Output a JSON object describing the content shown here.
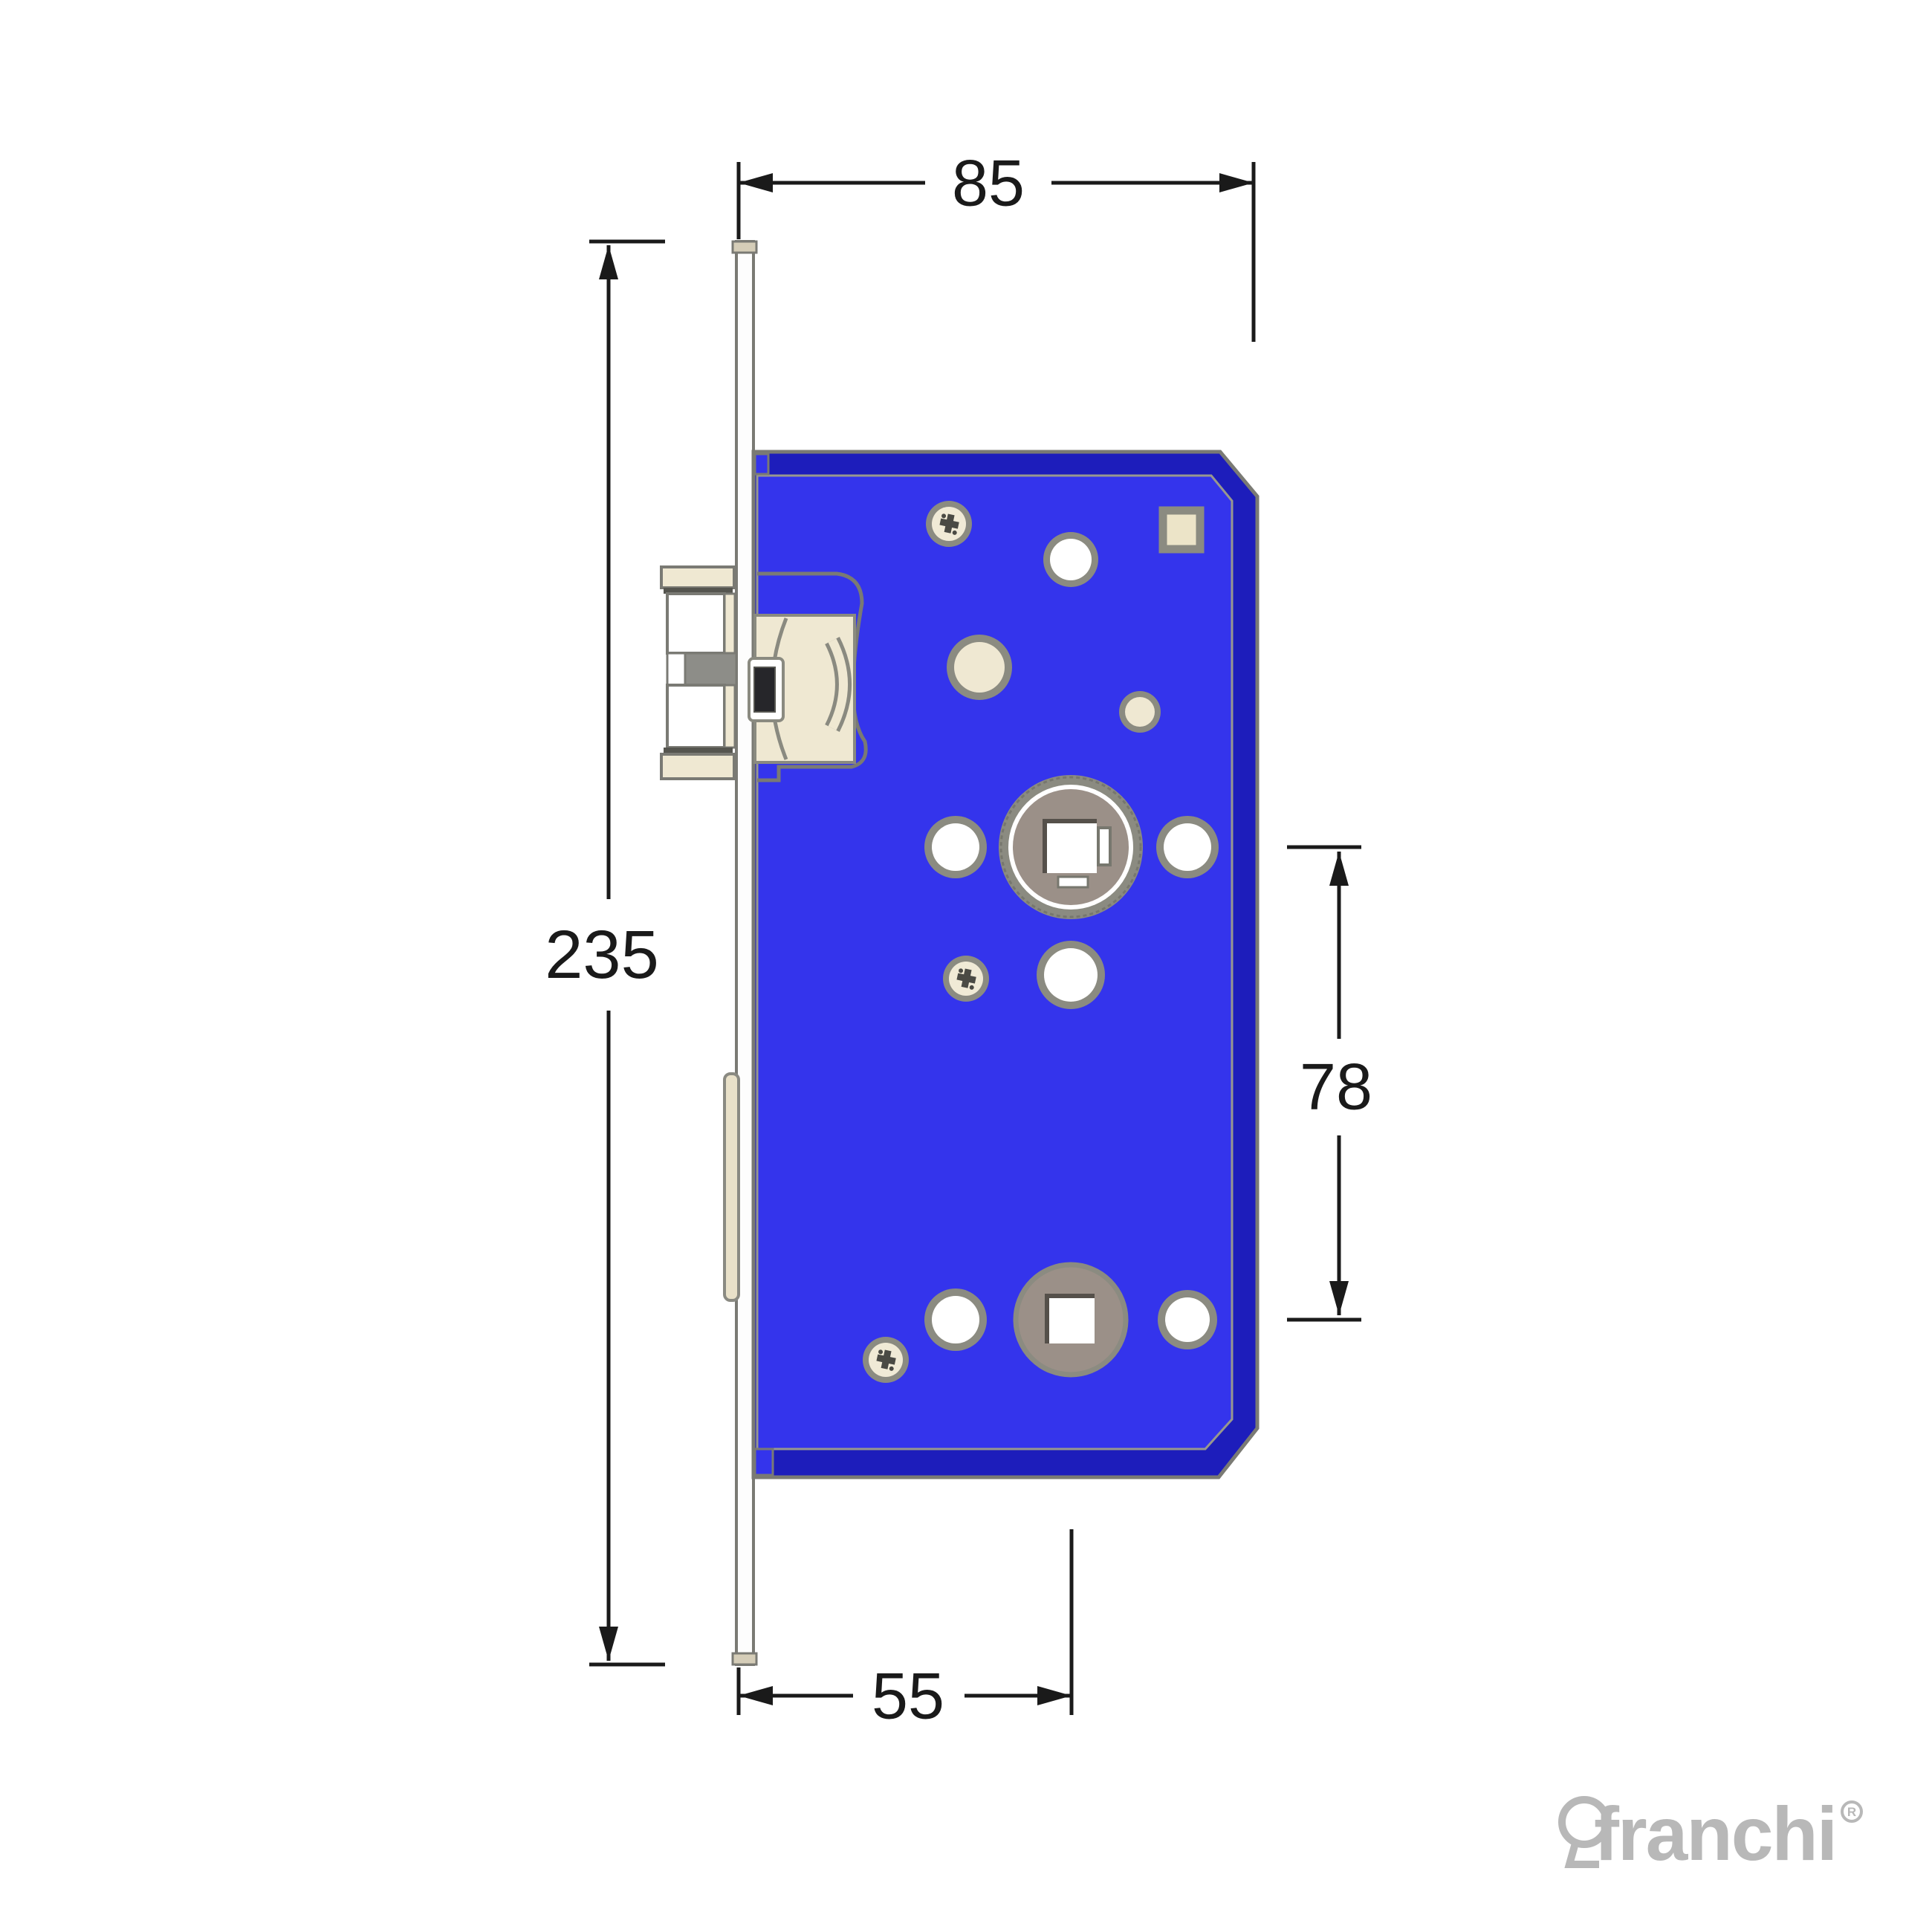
{
  "drawing": {
    "dimensions": {
      "case_depth": {
        "label": "85"
      },
      "faceplate_height": {
        "label": "235"
      },
      "hub_spacing": {
        "label": "78"
      },
      "backset": {
        "label": "55"
      }
    },
    "logo": {
      "brand": "franchi",
      "registered": "R"
    },
    "colors": {
      "body_blue": "#3434ec",
      "body_blue_dark": "#1d1dbb",
      "outline_gray": "#7a7a74",
      "inner_highlight": "#98988e",
      "cream": "#efe8d2",
      "taupe": "#9b9088",
      "hub_ring": "#8b8b81",
      "white": "#ffffff",
      "dim_black": "#1a1a1a",
      "logo_gray": "#b8b8b8",
      "screw_face": "#f0ead6",
      "screw_slot": "#4a4a44",
      "beige_square": "#ece4c8",
      "cap_beige": "#d5cdb8",
      "mid_gray": "#8d8d88",
      "shaft_dark": "#26262a",
      "shadow_line": "#55554f"
    }
  }
}
